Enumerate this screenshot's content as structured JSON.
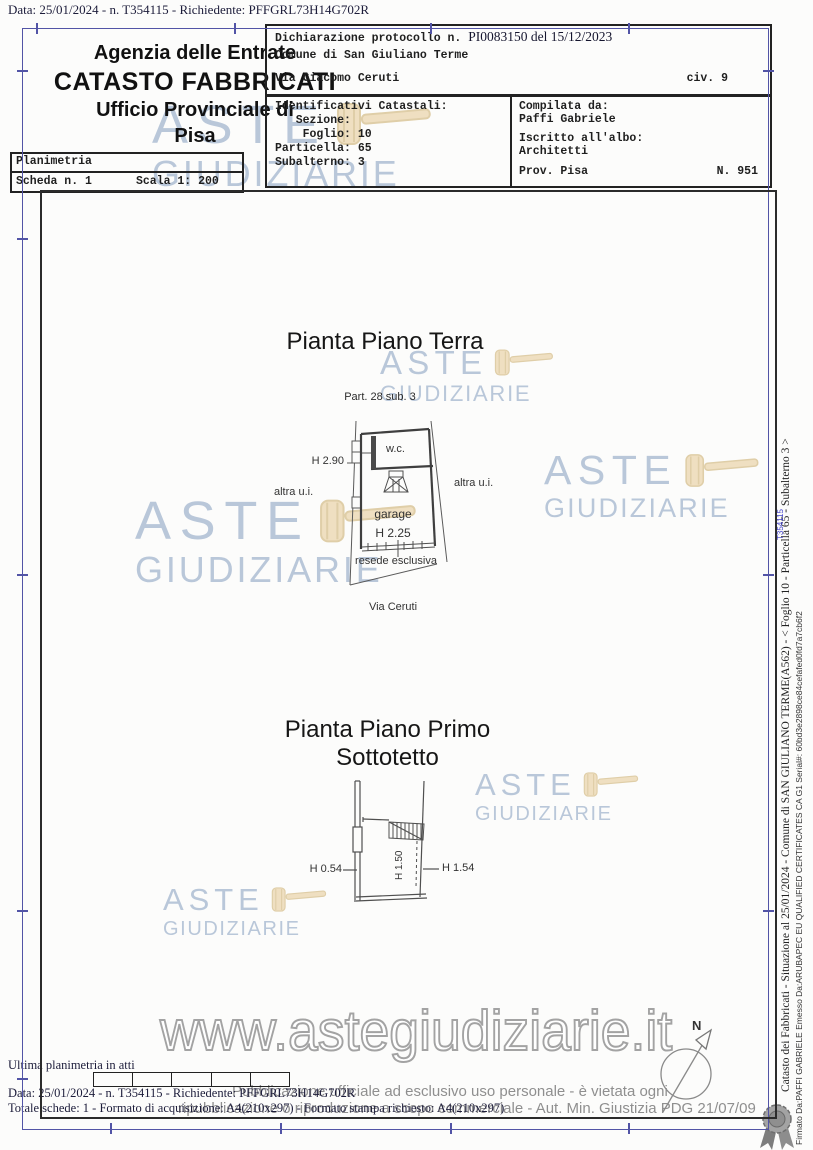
{
  "colors": {
    "frame_blue": "#5254a6",
    "frame_black": "#2b2b2b",
    "watermark_blue": "#b6c5d8",
    "gavel_tan": "#ecd9b3",
    "disclaimer_gray": "#8f8f8f",
    "plan_line": "#4a4a4a"
  },
  "page": {
    "top_line": "Data: 25/01/2024 - n. T354115 - Richiedente: PFFGRL73H14G702R"
  },
  "header": {
    "agency": {
      "line1": "Agenzia delle Entrate",
      "line2": "CATASTO FABBRICATI",
      "line3": "Ufficio Provinciale di",
      "line4": "Pisa"
    },
    "planimetria": {
      "title": "Planimetria",
      "scheda": "Scheda n. 1",
      "scala": "Scala 1: 200"
    },
    "declaration": {
      "protocol_label": "Dichiarazione protocollo n.",
      "protocol_value": "PI0083150 del 15/12/2023",
      "comune": "Comune di San Giuliano Terme",
      "via": "Via Giacomo Ceruti",
      "civ": "civ. 9"
    },
    "identificativi": {
      "lines": [
        "Identificativi Catastali:",
        "   Sezione:",
        "    Foglio: 10",
        "Particella: 65",
        "Subalterno: 3"
      ]
    },
    "compilata": {
      "label": "Compilata da:",
      "name": "Paffi Gabriele",
      "albo_label": "Iscritto all'albo:",
      "albo_value": "Architetti",
      "prov": "Prov. Pisa",
      "numero": "N. 951"
    }
  },
  "plan_terra": {
    "title": "Pianta Piano Terra",
    "part_label": "Part. 28 sub. 3",
    "wc": "w.c.",
    "h_wc": "H 2.90",
    "altra_ui_left": "altra u.i.",
    "altra_ui_right": "altra u.i.",
    "garage": "garage",
    "h_garage": "H 2.25",
    "resede": "resede esclusiva",
    "street": "Via Ceruti"
  },
  "plan_sottotetto": {
    "title": "Pianta Piano Primo Sottotetto",
    "h_left": "H 0.54",
    "h_mid": "H 1.50",
    "h_right": "H 1.54"
  },
  "watermarks": {
    "aste": "ASTE",
    "giudiziarie": "GIUDIZIARIE",
    "url": "www.astegiudiziarie.it"
  },
  "disclaimer": {
    "line1": "Pubblicazione ufficiale ad esclusivo uso personale - è vietata ogni",
    "line2": "ripubblicazione o riproduzione a scopo commerciale - Aut. Min. Giustizia PDG 21/07/09"
  },
  "footer": {
    "ultima": "Ultima planimetria in atti",
    "data_line": "Data: 25/01/2024 - n. T354115 - Richiedente: PFFGRL73H14G702R",
    "totale_line": "Totale schede: 1 - Formato di acquisizione: A4(210x297) - Formato stampa richiesto: A4(210x297)"
  },
  "sidebar": {
    "catasto_line": "Catasto dei Fabbricati - Situazione al 25/01/2024 - Comune di SAN GIULIANO TERME(A562) - < Foglio 10 - Particella 65 - Subalterno 3 >",
    "firma_line": "Firmato Da:PAFFI GABRIELE Emesso Da:ARUBAPEC EU QUALIFIED CERTIFICATES CA G1 Serial#: 60bd3e2898ce84cefafed0fd7a7cb6f2",
    "doc_mark": "T354115"
  },
  "compass": {
    "north": "N"
  }
}
